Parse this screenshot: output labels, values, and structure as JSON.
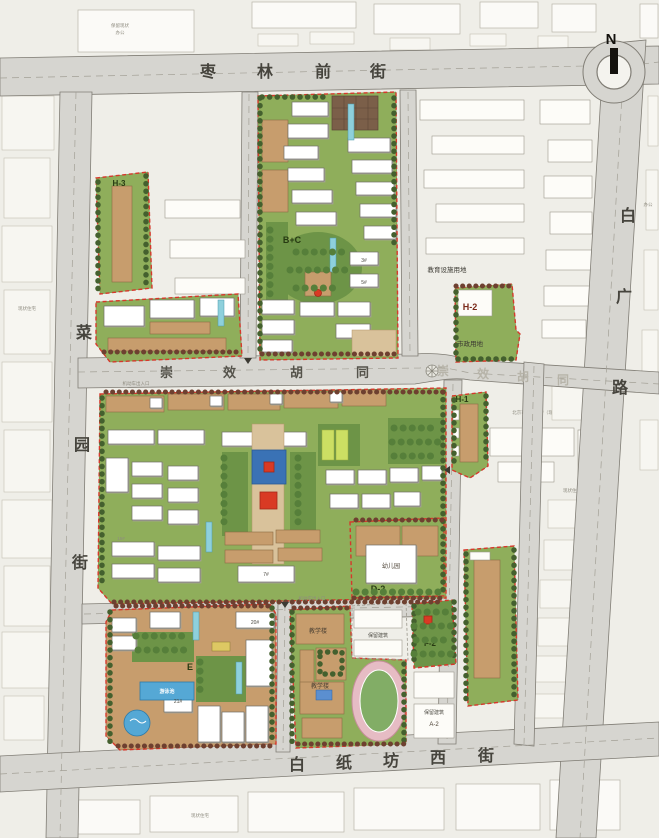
{
  "compass": {
    "north": "N"
  },
  "streets": {
    "zaolin": {
      "chars": [
        "枣",
        "林",
        "前",
        "街"
      ]
    },
    "chongxiao": {
      "chars": [
        "崇",
        "效",
        "胡",
        "同"
      ]
    },
    "chongxiao_east": {
      "chars": [
        "崇",
        "效",
        "胡",
        "同"
      ]
    },
    "caiyuan": {
      "chars": [
        "菜",
        "园",
        "街"
      ]
    },
    "baiguang": {
      "chars": [
        "白",
        "广",
        "路"
      ]
    },
    "baizhifang": {
      "chars": [
        "白",
        "纸",
        "坊",
        "西",
        "街"
      ]
    }
  },
  "parcels": {
    "h3": "H-3",
    "bc": "B+C",
    "h2": "H-2",
    "h2_use": "市政用地",
    "h1": "H-1",
    "d2": "D-2",
    "kindergarten": "幼儿园",
    "e": "E",
    "f2": "F-2",
    "a2": "A-2",
    "retained": "保留建筑",
    "school_bldg": "教学楼",
    "pool": "游泳池",
    "edu_land": "教育设施用地",
    "existing_school": "北京市重点中学（现状）"
  },
  "buildings": {
    "b20": "20#",
    "b21": "21#",
    "b3": "3#",
    "b5": "5#",
    "b15": "15#",
    "b7": "7#"
  },
  "context": {
    "existing_housing": "现状住宅",
    "office": "办公",
    "retain_existing": "保留现状",
    "vehicle_entrance": "机动车出入口"
  },
  "colors": {
    "parcel_boundary": "#d6382b",
    "parcel_green": "#8fae5b",
    "building_tan": "#c79d6d",
    "water_blue": "#55a8d5",
    "plaza_blue": "#3a72b5",
    "accent_red": "#d93a24",
    "track_pink": "#e0aeb8",
    "street_gray": "#d6d5d0"
  }
}
